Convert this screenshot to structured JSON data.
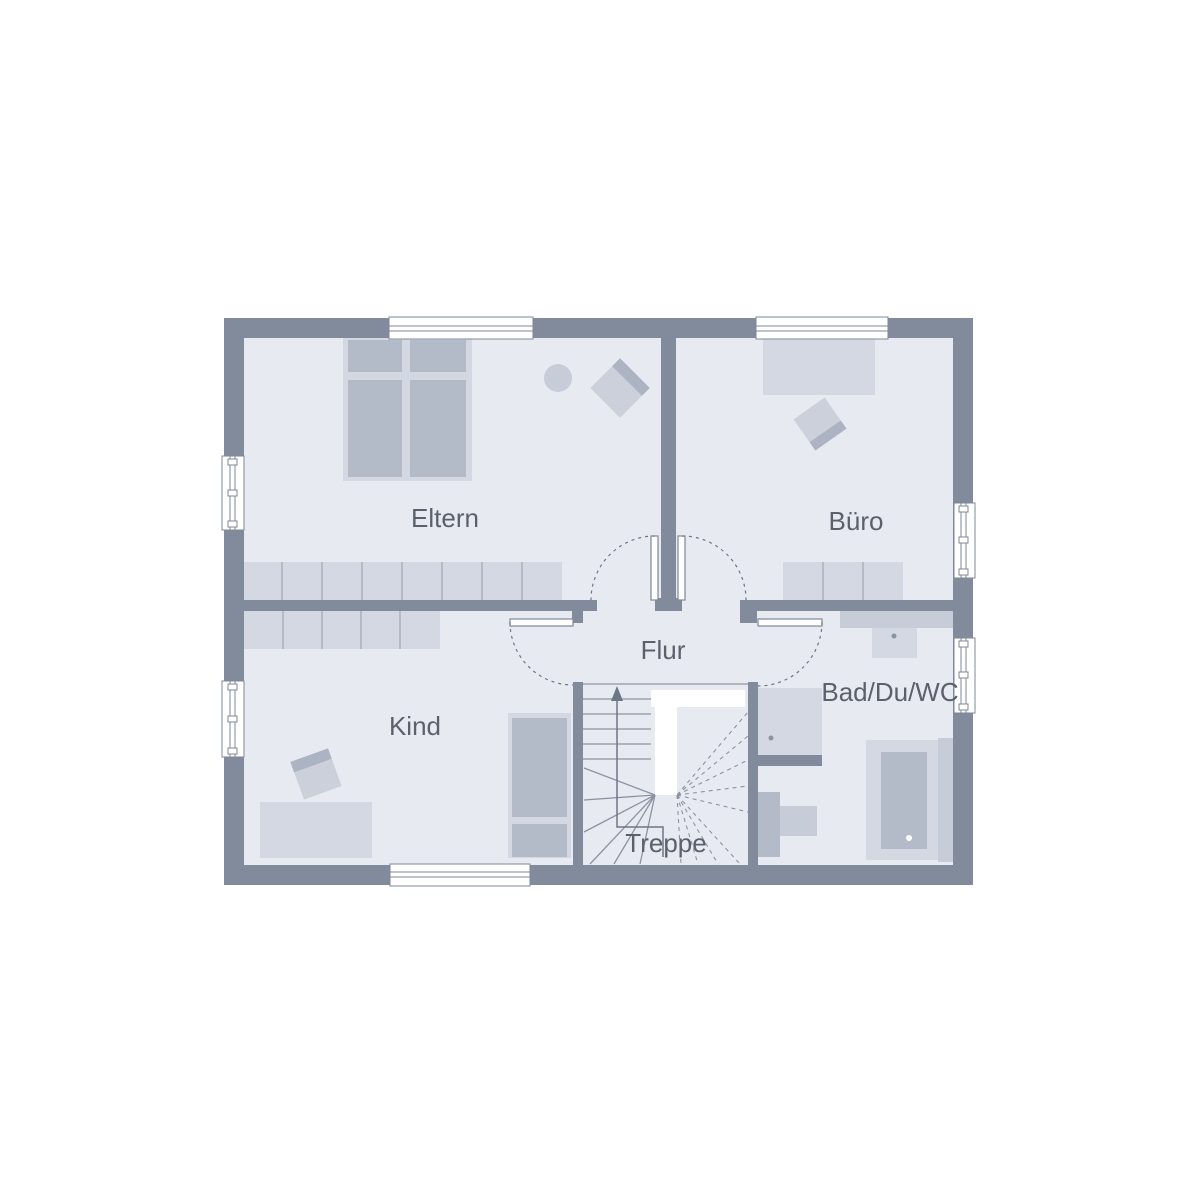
{
  "rooms": {
    "eltern": {
      "label": "Eltern"
    },
    "buero": {
      "label": "Büro"
    },
    "kind": {
      "label": "Kind"
    },
    "flur": {
      "label": "Flur"
    },
    "bad": {
      "label": "Bad/Du/WC"
    },
    "treppe": {
      "label": "Treppe"
    }
  },
  "stairs": {
    "direction": "up"
  },
  "palette": {
    "wall": "#828b9b",
    "floor": "#e8eaf1",
    "furniture_light": "#d4d8e2",
    "furniture_mid": "#c6ccd8",
    "furniture_dark": "#b3bac8",
    "chair_seat": "#cbd0db",
    "chair_back": "#acb3c2",
    "outline": "#7f8899",
    "step_line": "#8b93a3",
    "dash_line": "#6d7686",
    "text": "#5a616d",
    "window_white": "#ffffff"
  }
}
